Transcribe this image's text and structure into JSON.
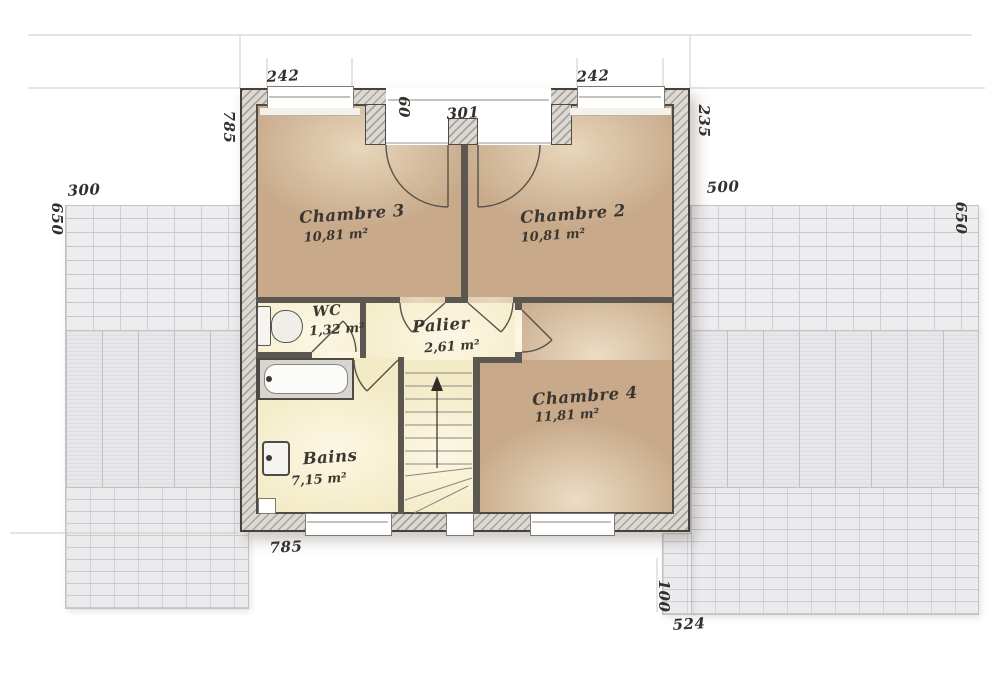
{
  "plan_type": "floor-plan-upper-storey",
  "rooms": {
    "chambre3": {
      "name": "Chambre 3",
      "area": "10,81 m²"
    },
    "chambre2": {
      "name": "Chambre 2",
      "area": "10,81 m²"
    },
    "chambre4": {
      "name": "Chambre 4",
      "area": "11,81 m²"
    },
    "wc": {
      "name": "WC",
      "area": "1,32 m²"
    },
    "palier": {
      "name": "Palier",
      "area": "2,61 m²"
    },
    "bains": {
      "name": "Bains",
      "area": "7,15 m²"
    }
  },
  "dimensions": {
    "top_window_left": "242",
    "top_window_right": "242",
    "niche_width": "301",
    "niche_depth": "60",
    "left_wall_height": "785",
    "right_wall_segment": "235",
    "roof_left_width": "300",
    "roof_left_height": "650",
    "roof_right_width": "500",
    "roof_right_height": "650",
    "bottom_wall_width": "785",
    "roof_bottom_right_height": "100",
    "roof_bottom_right_width": "524"
  },
  "colors": {
    "bedroom_floor": "#c8aa8b",
    "hall_floor": "#f3ebc6",
    "wall_hatch": "#dcd8d4",
    "wall_line": "#45403b",
    "partition": "#5d5751",
    "roof_tile": "#ededef",
    "dimension_text": "#33302c"
  }
}
